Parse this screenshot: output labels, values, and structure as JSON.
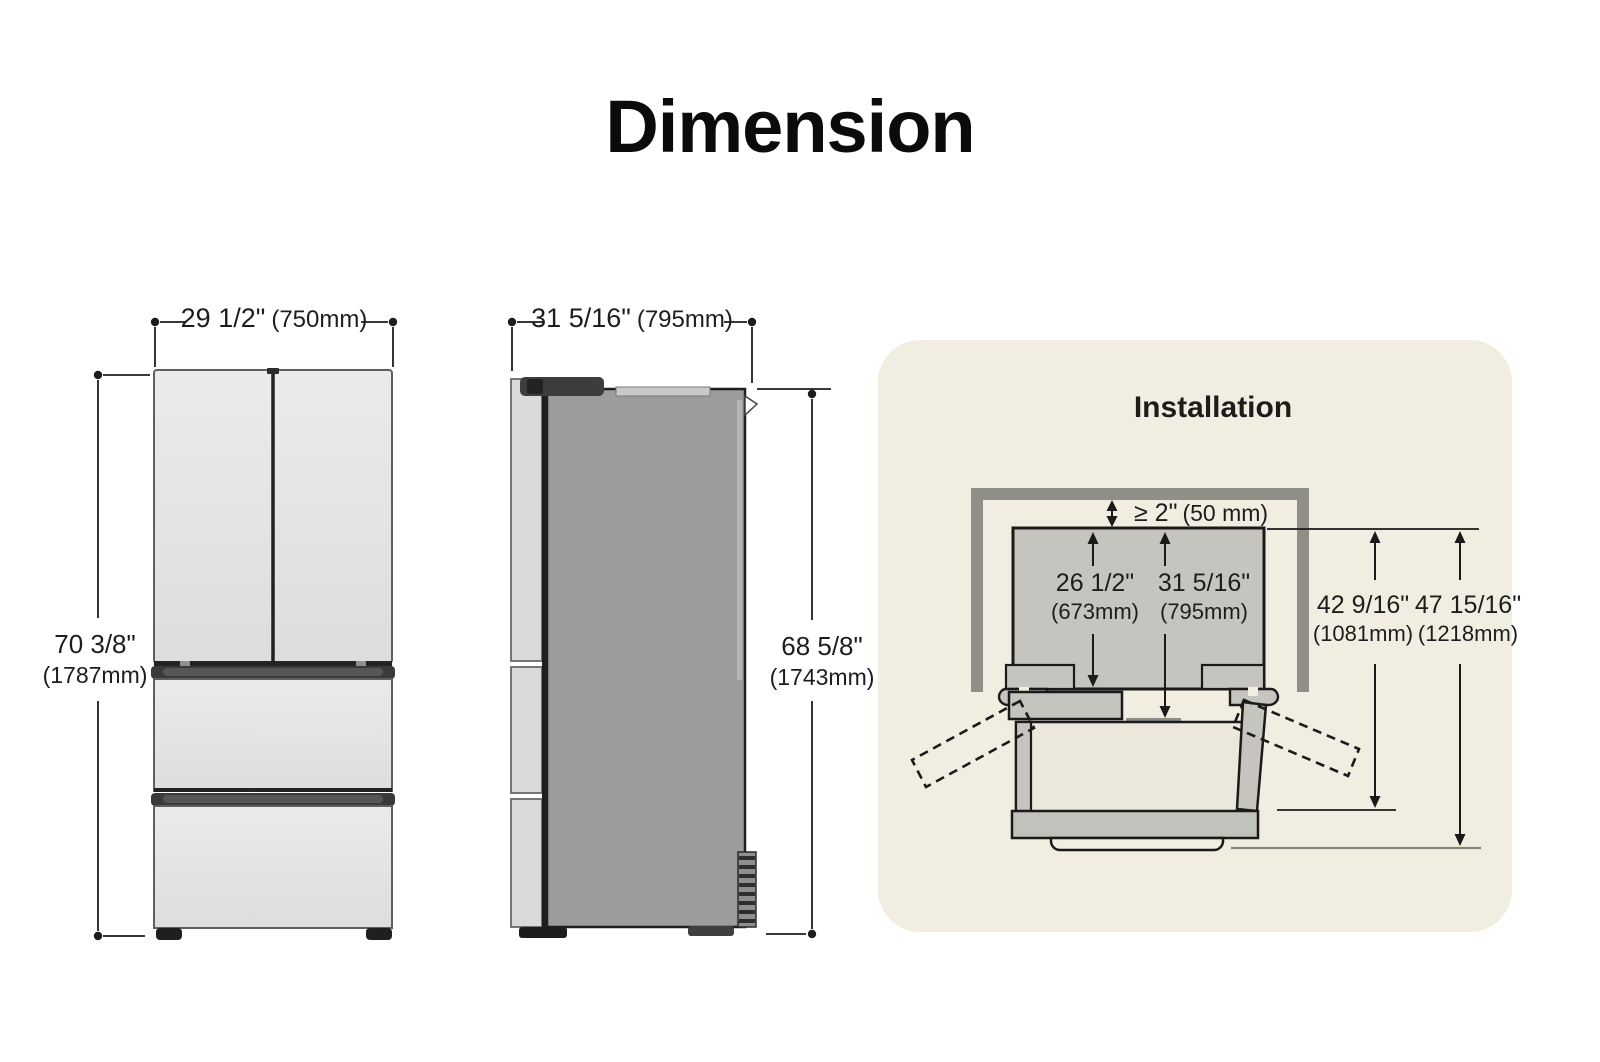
{
  "page": {
    "title": "Dimension"
  },
  "front_view": {
    "width": {
      "inch": "29 1/2\"",
      "mm": "(750mm)"
    },
    "height": {
      "inch": "70 3/8\"",
      "mm": "(1787mm)"
    }
  },
  "side_view": {
    "depth": {
      "inch": "31 5/16\"",
      "mm": "(795mm)"
    },
    "height": {
      "inch": "68 5/8\"",
      "mm": "(1743mm)"
    }
  },
  "installation": {
    "title": "Installation",
    "top_clearance": {
      "inch": "≥ 2\"",
      "mm": "(50 mm)"
    },
    "cabinet_depth": {
      "inch": "26 1/2\"",
      "mm": "(673mm)"
    },
    "depth_with_door": {
      "inch": "31 5/16\"",
      "mm": "(795mm)"
    },
    "depth_door_open": {
      "inch": "42 9/16\"",
      "mm": "(1081mm)"
    },
    "depth_total": {
      "inch": "47 15/16\"",
      "mm": "(1218mm)"
    }
  },
  "colors": {
    "background": "#ffffff",
    "panel_background": "#f1ede0",
    "wall_gray": "#8f8f87",
    "line_color": "#1d1d1d",
    "cabinet_gray": "#c6c4be",
    "fridge_side_gray": "#9c9c9a",
    "handle_dark": "#3a3a3a"
  }
}
